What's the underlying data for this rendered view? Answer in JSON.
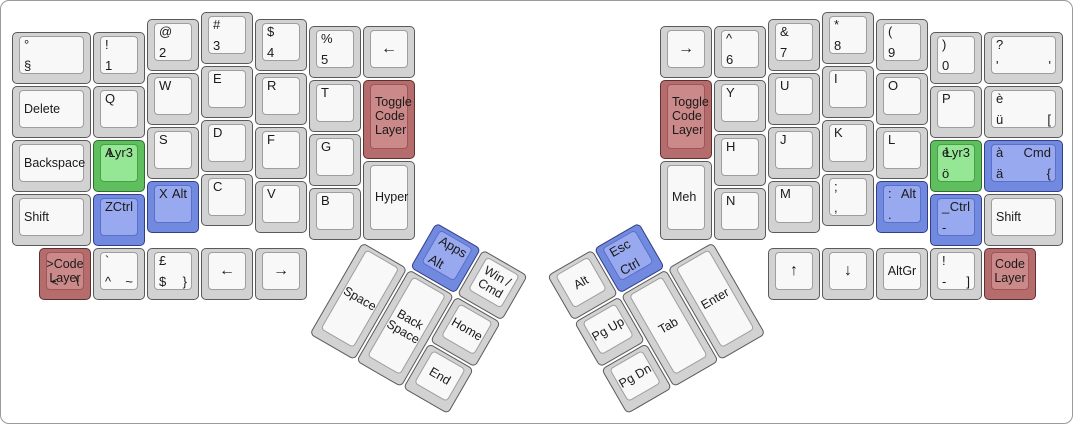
{
  "board": {
    "background": "#ffffff",
    "border_color": "#9a9a9a",
    "unit_px": 54,
    "origins": {
      "left": [
        10,
        10
      ],
      "right": [
        658,
        10
      ]
    },
    "palettes": {
      "grey": {
        "side": "#d2d2d2",
        "face": "#f8f8f8",
        "border": "#5a5a5a",
        "face_border": "#9e9e9e"
      },
      "green": {
        "side": "#5fbf5f",
        "face": "#95e795",
        "border": "#2e6b2e",
        "face_border": "#46a046"
      },
      "blue": {
        "side": "#7289e0",
        "face": "#98a9f0",
        "border": "#323f85",
        "face_border": "#5a70c8"
      },
      "red": {
        "side": "#b56c6c",
        "face": "#cc8989",
        "border": "#5f3030",
        "face_border": "#9e5555"
      }
    },
    "keys": [
      {
        "id": "key-degree-section",
        "hand": "left",
        "x": 0,
        "y": 0.375,
        "w": 1.5,
        "legends": {
          "tl": "°",
          "bl": "§"
        }
      },
      {
        "id": "key-delete",
        "hand": "left",
        "x": 0,
        "y": 1.375,
        "w": 1.5,
        "legends": {
          "ml": "Delete"
        }
      },
      {
        "id": "key-backspace",
        "hand": "left",
        "x": 0,
        "y": 2.375,
        "w": 1.5,
        "legends": {
          "ml": "Backspace"
        }
      },
      {
        "id": "key-shift-left",
        "hand": "left",
        "x": 0,
        "y": 3.375,
        "w": 1.5,
        "legends": {
          "ml": "Shift"
        }
      },
      {
        "id": "key-1",
        "hand": "left",
        "x": 1.5,
        "y": 0.375,
        "legends": {
          "tl": "!",
          "bl": "1"
        }
      },
      {
        "id": "key-q",
        "hand": "left",
        "x": 1.5,
        "y": 1.375,
        "legends": {
          "tl": "Q"
        }
      },
      {
        "id": "key-a-lyr3",
        "hand": "left",
        "x": 1.5,
        "y": 2.375,
        "color": "green",
        "legends": {
          "tl": "A",
          "tr": "Lyr3"
        }
      },
      {
        "id": "key-z-ctrl",
        "hand": "left",
        "x": 1.5,
        "y": 3.375,
        "color": "blue",
        "legends": {
          "tl": "Z",
          "tr": "Ctrl"
        }
      },
      {
        "id": "key-2",
        "hand": "left",
        "x": 2.5,
        "y": 0.125,
        "legends": {
          "tl": "@",
          "bl": "2"
        }
      },
      {
        "id": "key-w",
        "hand": "left",
        "x": 2.5,
        "y": 1.125,
        "legends": {
          "tl": "W"
        }
      },
      {
        "id": "key-s",
        "hand": "left",
        "x": 2.5,
        "y": 2.125,
        "legends": {
          "tl": "S"
        }
      },
      {
        "id": "key-x-alt",
        "hand": "left",
        "x": 2.5,
        "y": 3.125,
        "color": "blue",
        "legends": {
          "tl": "X",
          "tr": "Alt"
        }
      },
      {
        "id": "key-3",
        "hand": "left",
        "x": 3.5,
        "y": 0,
        "legends": {
          "tl": "#",
          "bl": "3"
        }
      },
      {
        "id": "key-e",
        "hand": "left",
        "x": 3.5,
        "y": 1,
        "legends": {
          "tl": "E"
        }
      },
      {
        "id": "key-d",
        "hand": "left",
        "x": 3.5,
        "y": 2,
        "legends": {
          "tl": "D"
        }
      },
      {
        "id": "key-c",
        "hand": "left",
        "x": 3.5,
        "y": 3,
        "legends": {
          "tl": "C"
        }
      },
      {
        "id": "key-4",
        "hand": "left",
        "x": 4.5,
        "y": 0.125,
        "legends": {
          "tl": "$",
          "bl": "4"
        }
      },
      {
        "id": "key-r",
        "hand": "left",
        "x": 4.5,
        "y": 1.125,
        "legends": {
          "tl": "R"
        }
      },
      {
        "id": "key-f",
        "hand": "left",
        "x": 4.5,
        "y": 2.125,
        "legends": {
          "tl": "F"
        }
      },
      {
        "id": "key-v",
        "hand": "left",
        "x": 4.5,
        "y": 3.125,
        "legends": {
          "tl": "V"
        }
      },
      {
        "id": "key-5",
        "hand": "left",
        "x": 5.5,
        "y": 0.25,
        "legends": {
          "tl": "%",
          "bl": "5"
        }
      },
      {
        "id": "key-t",
        "hand": "left",
        "x": 5.5,
        "y": 1.25,
        "legends": {
          "tl": "T"
        }
      },
      {
        "id": "key-g",
        "hand": "left",
        "x": 5.5,
        "y": 2.25,
        "legends": {
          "tl": "G"
        }
      },
      {
        "id": "key-b",
        "hand": "left",
        "x": 5.5,
        "y": 3.25,
        "legends": {
          "tl": "B"
        }
      },
      {
        "id": "key-arrow-left-inner",
        "hand": "left",
        "x": 6.5,
        "y": 0.25,
        "legends": {
          "c": "←"
        }
      },
      {
        "id": "key-toggle-code-layer-left",
        "hand": "left",
        "x": 6.5,
        "y": 1.25,
        "h": 1.5,
        "color": "red",
        "legends": {
          "ml": "Toggle\nCode\nLayer"
        }
      },
      {
        "id": "key-hyper",
        "hand": "left",
        "x": 6.5,
        "y": 2.75,
        "h": 1.5,
        "legends": {
          "ml": "Hyper"
        }
      },
      {
        "id": "key-code-layer-bottom-left",
        "hand": "left",
        "x": 0.5,
        "y": 4.375,
        "color": "red",
        "legends": {
          "c": ">Code\nLayer",
          "bl": "<",
          "br": "\\"
        }
      },
      {
        "id": "key-grave-caret-tilde",
        "hand": "left",
        "x": 1.5,
        "y": 4.375,
        "legends": {
          "tl": "`",
          "bl": "^",
          "br": "~"
        }
      },
      {
        "id": "key-pound-dollar",
        "hand": "left",
        "x": 2.5,
        "y": 4.375,
        "legends": {
          "tl": "£",
          "bl": "$",
          "br": "}"
        }
      },
      {
        "id": "key-arrow-left-bottom",
        "hand": "left",
        "x": 3.5,
        "y": 4.375,
        "legends": {
          "c": "←"
        }
      },
      {
        "id": "key-arrow-right-bottom",
        "hand": "left",
        "x": 4.5,
        "y": 4.375,
        "legends": {
          "c": "→"
        }
      },
      {
        "id": "key-apps-alt",
        "hand": "left",
        "x": 7.5,
        "y": 3.25,
        "color": "blue",
        "rot": {
          "angle": 30,
          "cx": 6.5,
          "cy": 4.25
        },
        "legends": {
          "tl": "Apps",
          "bl": "Alt"
        }
      },
      {
        "id": "key-win-cmd",
        "hand": "left",
        "x": 8.5,
        "y": 3.25,
        "rot": {
          "angle": 30,
          "cx": 6.5,
          "cy": 4.25
        },
        "legends": {
          "c": "Win /\nCmd"
        }
      },
      {
        "id": "key-space",
        "hand": "left",
        "x": 6.5,
        "y": 4.25,
        "h": 2,
        "rot": {
          "angle": 30,
          "cx": 6.5,
          "cy": 4.25
        },
        "legends": {
          "c": "Space"
        }
      },
      {
        "id": "key-back-space-thumb",
        "hand": "left",
        "x": 7.5,
        "y": 4.25,
        "h": 2,
        "rot": {
          "angle": 30,
          "cx": 6.5,
          "cy": 4.25
        },
        "legends": {
          "c": "Back\nSpace"
        }
      },
      {
        "id": "key-home",
        "hand": "left",
        "x": 8.5,
        "y": 4.25,
        "rot": {
          "angle": 30,
          "cx": 6.5,
          "cy": 4.25
        },
        "legends": {
          "c": "Home"
        }
      },
      {
        "id": "key-end",
        "hand": "left",
        "x": 8.5,
        "y": 5.25,
        "rot": {
          "angle": 30,
          "cx": 6.5,
          "cy": 4.25
        },
        "legends": {
          "c": "End"
        }
      },
      {
        "id": "key-arrow-right-inner",
        "hand": "right",
        "x": 0,
        "y": 0.25,
        "legends": {
          "c": "→"
        }
      },
      {
        "id": "key-toggle-code-layer-right",
        "hand": "right",
        "x": 0,
        "y": 1.25,
        "h": 1.5,
        "color": "red",
        "legends": {
          "ml": "Toggle\nCode\nLayer"
        }
      },
      {
        "id": "key-meh",
        "hand": "right",
        "x": 0,
        "y": 2.75,
        "h": 1.5,
        "legends": {
          "ml": "Meh"
        }
      },
      {
        "id": "key-6",
        "hand": "right",
        "x": 1,
        "y": 0.25,
        "legends": {
          "tl": "^",
          "bl": "6"
        }
      },
      {
        "id": "key-y",
        "hand": "right",
        "x": 1,
        "y": 1.25,
        "legends": {
          "tl": "Y"
        }
      },
      {
        "id": "key-h",
        "hand": "right",
        "x": 1,
        "y": 2.25,
        "legends": {
          "tl": "H"
        }
      },
      {
        "id": "key-n",
        "hand": "right",
        "x": 1,
        "y": 3.25,
        "legends": {
          "tl": "N"
        }
      },
      {
        "id": "key-7",
        "hand": "right",
        "x": 2,
        "y": 0.125,
        "legends": {
          "tl": "&",
          "bl": "7"
        }
      },
      {
        "id": "key-u",
        "hand": "right",
        "x": 2,
        "y": 1.125,
        "legends": {
          "tl": "U"
        }
      },
      {
        "id": "key-j",
        "hand": "right",
        "x": 2,
        "y": 2.125,
        "legends": {
          "tl": "J"
        }
      },
      {
        "id": "key-m",
        "hand": "right",
        "x": 2,
        "y": 3.125,
        "legends": {
          "tl": "M"
        }
      },
      {
        "id": "key-8",
        "hand": "right",
        "x": 3,
        "y": 0,
        "legends": {
          "tl": "*",
          "bl": "8"
        }
      },
      {
        "id": "key-i",
        "hand": "right",
        "x": 3,
        "y": 1,
        "legends": {
          "tl": "I"
        }
      },
      {
        "id": "key-k",
        "hand": "right",
        "x": 3,
        "y": 2,
        "legends": {
          "tl": "K"
        }
      },
      {
        "id": "key-semicolon-comma",
        "hand": "right",
        "x": 3,
        "y": 3,
        "legends": {
          "tl": ";",
          "bl": ","
        }
      },
      {
        "id": "key-9",
        "hand": "right",
        "x": 4,
        "y": 0.125,
        "legends": {
          "tl": "(",
          "bl": "9"
        }
      },
      {
        "id": "key-o",
        "hand": "right",
        "x": 4,
        "y": 1.125,
        "legends": {
          "tl": "O"
        }
      },
      {
        "id": "key-l",
        "hand": "right",
        "x": 4,
        "y": 2.125,
        "legends": {
          "tl": "L"
        }
      },
      {
        "id": "key-colon-alt",
        "hand": "right",
        "x": 4,
        "y": 3.125,
        "color": "blue",
        "legends": {
          "tl": ":",
          "tr": "Alt",
          "bl": "."
        }
      },
      {
        "id": "key-0",
        "hand": "right",
        "x": 5,
        "y": 0.375,
        "legends": {
          "tl": ")",
          "bl": "0"
        }
      },
      {
        "id": "key-p",
        "hand": "right",
        "x": 5,
        "y": 1.375,
        "legends": {
          "tl": "P"
        }
      },
      {
        "id": "key-eacute-lyr3",
        "hand": "right",
        "x": 5,
        "y": 2.375,
        "color": "green",
        "legends": {
          "tl": "é",
          "tr": "Lyr3",
          "bl": "ö"
        }
      },
      {
        "id": "key-underscore-ctrl",
        "hand": "right",
        "x": 5,
        "y": 3.375,
        "color": "blue",
        "legends": {
          "tl": "_",
          "tr": "Ctrl",
          "bl": "-"
        }
      },
      {
        "id": "key-question-apostrophe",
        "hand": "right",
        "x": 6,
        "y": 0.375,
        "w": 1.5,
        "legends": {
          "tl": "?",
          "bl": "'",
          "br": "'"
        }
      },
      {
        "id": "key-egrave-udiaeresis",
        "hand": "right",
        "x": 6,
        "y": 1.375,
        "w": 1.5,
        "legends": {
          "tl": "è",
          "bl": "ü",
          "br": "["
        }
      },
      {
        "id": "key-agrave-cmd",
        "hand": "right",
        "x": 6,
        "y": 2.375,
        "w": 1.5,
        "color": "blue",
        "legends": {
          "tl": "à",
          "tr": "Cmd",
          "bl": "ä",
          "br": "{"
        }
      },
      {
        "id": "key-shift-right",
        "hand": "right",
        "x": 6,
        "y": 3.375,
        "w": 1.5,
        "legends": {
          "ml": "Shift"
        }
      },
      {
        "id": "key-arrow-up",
        "hand": "right",
        "x": 2,
        "y": 4.375,
        "legends": {
          "c": "↑"
        }
      },
      {
        "id": "key-arrow-down",
        "hand": "right",
        "x": 3,
        "y": 4.375,
        "legends": {
          "c": "↓"
        }
      },
      {
        "id": "key-altgr",
        "hand": "right",
        "x": 4,
        "y": 4.375,
        "legends": {
          "c": "AltGr"
        }
      },
      {
        "id": "key-exclam-bracket",
        "hand": "right",
        "x": 5,
        "y": 4.375,
        "legends": {
          "tl": "!",
          "bl": "-",
          "br": "]"
        }
      },
      {
        "id": "key-code-layer-bottom-right",
        "hand": "right",
        "x": 6,
        "y": 4.375,
        "color": "red",
        "legends": {
          "c": "Code\nLayer"
        }
      },
      {
        "id": "key-alt-thumb",
        "hand": "right",
        "x": -2,
        "y": 3.25,
        "rot": {
          "angle": -30,
          "cx": 1,
          "cy": 4.25
        },
        "legends": {
          "c": "Alt"
        }
      },
      {
        "id": "key-esc-ctrl",
        "hand": "right",
        "x": -1,
        "y": 3.25,
        "color": "blue",
        "rot": {
          "angle": -30,
          "cx": 1,
          "cy": 4.25
        },
        "legends": {
          "tl": "Esc",
          "bl": "Ctrl"
        }
      },
      {
        "id": "key-pg-up",
        "hand": "right",
        "x": -2,
        "y": 4.25,
        "rot": {
          "angle": -30,
          "cx": 1,
          "cy": 4.25
        },
        "legends": {
          "c": "Pg Up"
        }
      },
      {
        "id": "key-tab",
        "hand": "right",
        "x": -1,
        "y": 4.25,
        "h": 2,
        "rot": {
          "angle": -30,
          "cx": 1,
          "cy": 4.25
        },
        "legends": {
          "c": "Tab"
        }
      },
      {
        "id": "key-enter",
        "hand": "right",
        "x": 0,
        "y": 4.25,
        "h": 2,
        "rot": {
          "angle": -30,
          "cx": 1,
          "cy": 4.25
        },
        "legends": {
          "c": "Enter"
        }
      },
      {
        "id": "key-pg-dn",
        "hand": "right",
        "x": -2,
        "y": 5.25,
        "rot": {
          "angle": -30,
          "cx": 1,
          "cy": 4.25
        },
        "legends": {
          "c": "Pg Dn"
        }
      }
    ]
  }
}
